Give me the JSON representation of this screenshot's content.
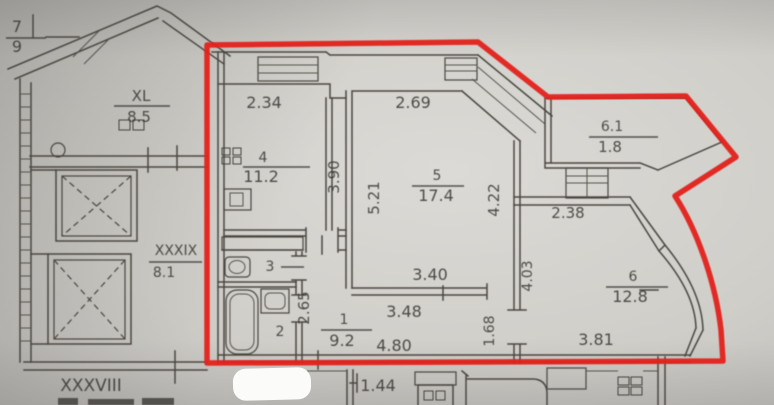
{
  "colors": {
    "outline": "#e3201c",
    "ink": "#3b3935",
    "paper_light": "#dcdad6",
    "paper_dark": "#a9a8a5"
  },
  "rooms": [
    {
      "key": "corridor-7",
      "number": "7",
      "area": "9",
      "num_xy": [
        17,
        32
      ],
      "area_xy": [
        17,
        52
      ],
      "bar": [
        6,
        38,
        46,
        38
      ],
      "size": 16,
      "area_size": 16
    },
    {
      "key": "xl",
      "number": "XL",
      "area": "8.5",
      "num_xy": [
        141,
        101
      ],
      "area_xy": [
        139,
        122
      ],
      "bar": [
        114,
        106,
        170,
        106
      ],
      "size": 15,
      "area_size": 15
    },
    {
      "key": "xxxix",
      "number": "XXXIX",
      "area": "8.1",
      "num_xy": [
        176,
        255
      ],
      "area_xy": [
        164,
        277
      ],
      "bar": [
        149,
        262,
        202,
        262
      ],
      "size": 14,
      "area_size": 14
    },
    {
      "key": "xxxviii",
      "number": "XXXVIII",
      "area": "",
      "num_xy": [
        91,
        391
      ],
      "area_xy": null,
      "bar": null,
      "size": 17,
      "area_size": 0
    },
    {
      "key": "room-4",
      "number": "4",
      "area": "11.2",
      "num_xy": [
        263,
        162
      ],
      "area_xy": [
        261,
        182
      ],
      "bar": [
        243,
        167,
        310,
        167
      ],
      "size": 14,
      "area_size": 16
    },
    {
      "key": "room-5",
      "number": "5",
      "area": "17.4",
      "num_xy": [
        437,
        180
      ],
      "area_xy": [
        436,
        201
      ],
      "bar": [
        412,
        186,
        464,
        186
      ],
      "size": 14,
      "area_size": 16
    },
    {
      "key": "room-1",
      "number": "1",
      "area": "9.2",
      "num_xy": [
        344,
        324
      ],
      "area_xy": [
        342,
        346
      ],
      "bar": [
        321,
        330,
        372,
        330
      ],
      "size": 14,
      "area_size": 16
    },
    {
      "key": "room-2",
      "number": "2",
      "area": "",
      "num_xy": [
        280,
        336
      ],
      "area_xy": null,
      "bar": null,
      "size": 14,
      "area_size": 0
    },
    {
      "key": "room-3",
      "number": "3",
      "area": "",
      "num_xy": [
        270,
        271
      ],
      "area_xy": null,
      "bar": [
        281,
        267,
        304,
        267
      ],
      "size": 14,
      "area_size": 0
    },
    {
      "key": "room-6",
      "number": "6",
      "area": "12.8",
      "num_xy": [
        633,
        281
      ],
      "area_xy": [
        630,
        302
      ],
      "bar": [
        606,
        287,
        668,
        287
      ],
      "size": 14,
      "area_size": 16
    },
    {
      "key": "balcony-6-1",
      "number": "6.1",
      "area": "1.8",
      "num_xy": [
        612,
        131
      ],
      "area_xy": [
        610,
        152
      ],
      "bar": [
        589,
        137,
        658,
        137
      ],
      "size": 14,
      "area_size": 15
    }
  ],
  "dimensions": [
    {
      "value": "2.34",
      "xy": [
        264,
        108
      ],
      "rot": 0,
      "size": 16
    },
    {
      "value": "2.69",
      "xy": [
        413,
        108
      ],
      "rot": 0,
      "size": 16
    },
    {
      "value": "3.90",
      "xy": [
        339,
        177
      ],
      "rot": -90,
      "size": 15
    },
    {
      "value": "5.21",
      "xy": [
        379,
        198
      ],
      "rot": -90,
      "size": 15
    },
    {
      "value": "4.22",
      "xy": [
        499,
        200
      ],
      "rot": -90,
      "size": 15
    },
    {
      "value": "3.40",
      "xy": [
        430,
        280
      ],
      "rot": 0,
      "size": 16
    },
    {
      "value": "3.48",
      "xy": [
        404,
        317
      ],
      "rot": 0,
      "size": 16
    },
    {
      "value": "4.80",
      "xy": [
        394,
        351
      ],
      "rot": 0,
      "size": 16
    },
    {
      "value": "2.65",
      "xy": [
        309,
        308
      ],
      "rot": -90,
      "size": 15
    },
    {
      "value": "1.68",
      "xy": [
        494,
        331
      ],
      "rot": -90,
      "size": 14
    },
    {
      "value": "4.03",
      "xy": [
        532,
        276
      ],
      "rot": -90,
      "size": 14
    },
    {
      "value": "2.38",
      "xy": [
        568,
        218
      ],
      "rot": 0,
      "size": 15
    },
    {
      "value": "3.81",
      "xy": [
        596,
        345
      ],
      "rot": 0,
      "size": 16
    },
    {
      "value": "1.44",
      "xy": [
        378,
        391
      ],
      "rot": 0,
      "size": 16
    }
  ]
}
